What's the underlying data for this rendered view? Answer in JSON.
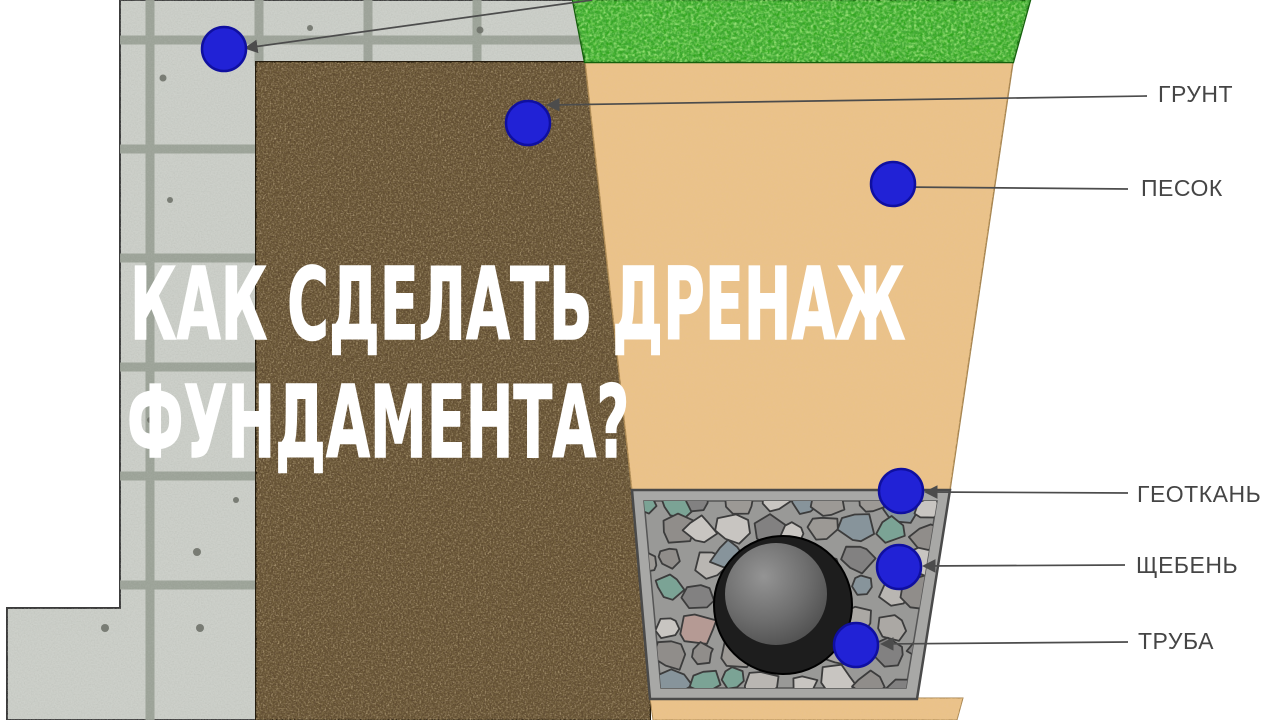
{
  "title": {
    "line1": "КАК СДЕЛАТЬ ДРЕНАЖ",
    "line2": "ФУНДАМЕНТА?"
  },
  "labels": [
    {
      "id": "grunt",
      "text": "ГРУНТ"
    },
    {
      "id": "pesok",
      "text": "ПЕСОК"
    },
    {
      "id": "geotkan",
      "text": "ГЕОТКАНЬ"
    },
    {
      "id": "shcheben",
      "text": "ЩЕБЕНЬ"
    },
    {
      "id": "truba",
      "text": "ТРУБА"
    }
  ],
  "callout_markers": {
    "count": 6,
    "shape": "dot"
  },
  "colors": {
    "marker_blue": "#2122d6",
    "marker_blue_edge": "#0f0fa0",
    "leader_line": "#4c4c4c",
    "label_text": "#454545",
    "title_text": "#ffffff",
    "concrete": "#cdd0ca",
    "grout": "#99a095",
    "soil": "#5d4930",
    "sand": "#eac28c",
    "grass": "#2fa61c",
    "gravel_base": "#a3a19f",
    "frame_gray": "#a8a8a6",
    "pipe_dark": "#1d1d1d",
    "pipe_inner": "#6e6e6e"
  }
}
